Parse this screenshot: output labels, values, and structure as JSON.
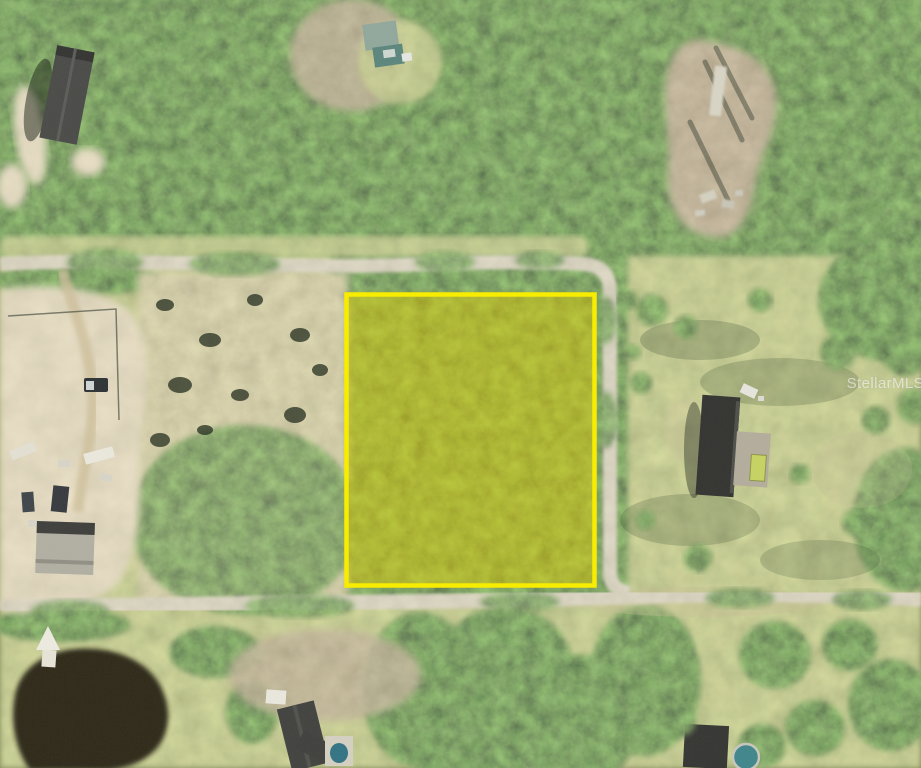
{
  "watermark": {
    "text": "StellarMLS"
  },
  "parcel_highlight": {
    "outline_color": "#f8ec00",
    "fill_color": "rgba(225,205,0,0.47)"
  },
  "palette": {
    "forest_green": "#2c4527",
    "grass_olive": "#8f996f",
    "sand_tan": "#c4b186",
    "dirt_brown": "#87745",
    "road_tan": "#b3ab92",
    "pond_dark": "#221b11",
    "dark_roof": "#2d2d2b",
    "light_roof": "#b0aea1",
    "pool_teal": "#3a8489"
  }
}
